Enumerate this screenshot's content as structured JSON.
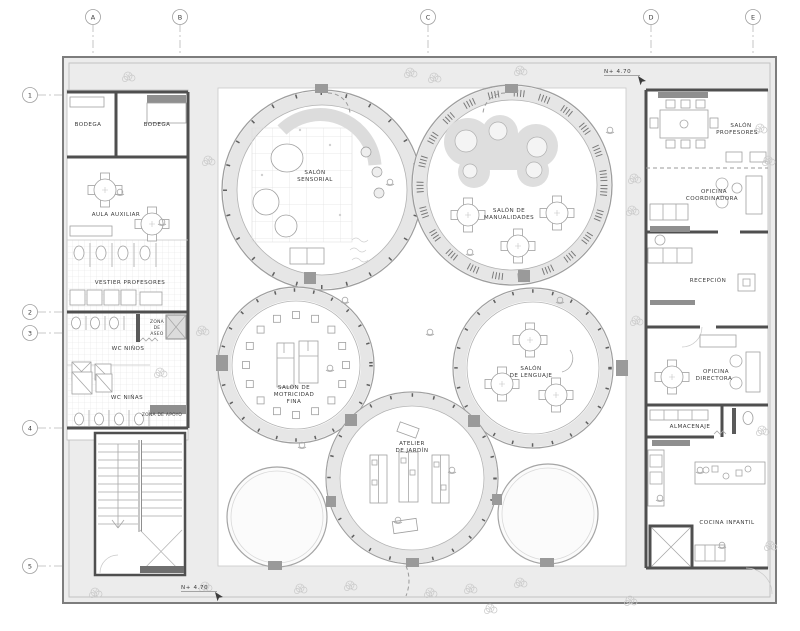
{
  "drawing": {
    "type": "architectural-floor-plan",
    "grid": {
      "columns": [
        "A",
        "B",
        "C",
        "D",
        "E"
      ],
      "rows": [
        "1",
        "2",
        "3",
        "4",
        "5"
      ]
    },
    "levels": {
      "top": "N+   4.70",
      "bottom": "N+   4.70"
    },
    "rooms": {
      "left": [
        {
          "id": "bodega-1",
          "lines": [
            "BODEGA"
          ]
        },
        {
          "id": "bodega-2",
          "lines": [
            "BODEGA"
          ]
        },
        {
          "id": "aula-auxiliar",
          "lines": [
            "AULA AUXILIAR"
          ]
        },
        {
          "id": "vestier-profesores",
          "lines": [
            "VESTIER  PROFESORES"
          ]
        },
        {
          "id": "wc-ninos",
          "lines": [
            "WC NIÑOS"
          ]
        },
        {
          "id": "zona-de-aseo",
          "lines": [
            "ZONA",
            "DE",
            "ASEO"
          ]
        },
        {
          "id": "wc-ninas",
          "lines": [
            "WC NIÑAS"
          ]
        },
        {
          "id": "zona-de-apoyo",
          "lines": [
            "ZONA DE APOYO"
          ]
        }
      ],
      "center": [
        {
          "id": "salon-sensorial",
          "lines": [
            "SALÓN",
            "SENSORIAL"
          ]
        },
        {
          "id": "salon-de-manualidades",
          "lines": [
            "SALÓN DE",
            "MANUALIDADES"
          ]
        },
        {
          "id": "salon-de-motricidad-fina",
          "lines": [
            "SALÓN DE",
            "MOTRICIDAD",
            "FINA"
          ]
        },
        {
          "id": "salon-de-lenguaje",
          "lines": [
            "SALÓN",
            "DE LENGUAJE"
          ]
        },
        {
          "id": "atelier-de-jardin",
          "lines": [
            "ATELIER",
            "DE JARDÍN"
          ]
        }
      ],
      "right": [
        {
          "id": "salon-profesores",
          "lines": [
            "SALÓN",
            "PROFESORES"
          ]
        },
        {
          "id": "oficina-coordinadora",
          "lines": [
            "OFICINA",
            "COORDINADORA"
          ]
        },
        {
          "id": "recepcion",
          "lines": [
            "RECEPCIÓN"
          ]
        },
        {
          "id": "oficina-directora",
          "lines": [
            "OFICINA",
            "DIRECTORA"
          ]
        },
        {
          "id": "almacenaje",
          "lines": [
            "ALMACENAJE"
          ]
        },
        {
          "id": "cocina-infantil",
          "lines": [
            "COCINA INFANTIL"
          ]
        }
      ]
    },
    "palette": {
      "wall": "#4f4f4f",
      "corridor_fill": "#ececec",
      "ring_fill": "#e6e6e6",
      "blob_fill": "#dedede",
      "line": "#a8a8a8",
      "text": "#3c3c3c"
    }
  }
}
